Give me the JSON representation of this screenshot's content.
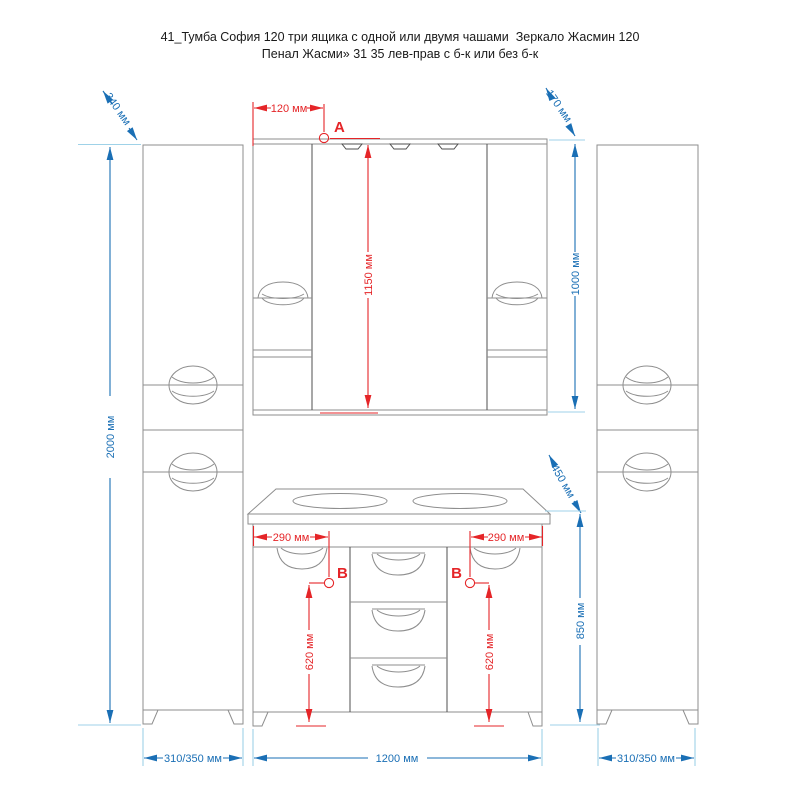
{
  "title": {
    "line1": "41_Тумба София 120 три ящика с одной или двумя чашами  Зеркало Жасмин 120",
    "line2": "Пенал Жасми» 31 35 лев-прав с б-к или без б-к"
  },
  "markers": {
    "point_a": "A",
    "point_b_left": "B",
    "point_b_right": "B"
  },
  "dimensions": {
    "pencil_depth_left": "340 мм",
    "light_offset_top": "120 мм",
    "mirror_depth": "170 мм",
    "mirror_height": "1150 мм",
    "pencil_upper_section_height": "1000 мм",
    "pencil_total_height": "2000 мм",
    "countertop_depth": "450 мм",
    "socket_offset_left": "290 мм",
    "socket_offset_right": "290 мм",
    "socket_height_left": "620 мм",
    "socket_height_right": "620 мм",
    "vanity_total_height": "850 мм",
    "vanity_width": "1200 мм",
    "pencil_width_left": "310/350 мм",
    "pencil_width_right": "310/350 мм"
  },
  "colors": {
    "dimension_blue": "#1a6fb5",
    "extension_cyan": "#9fd2e8",
    "dimension_red": "#e52528",
    "furniture_line_gray": "#8e8e8e",
    "furniture_line_dark": "#4f4f4f",
    "background": "#ffffff"
  }
}
